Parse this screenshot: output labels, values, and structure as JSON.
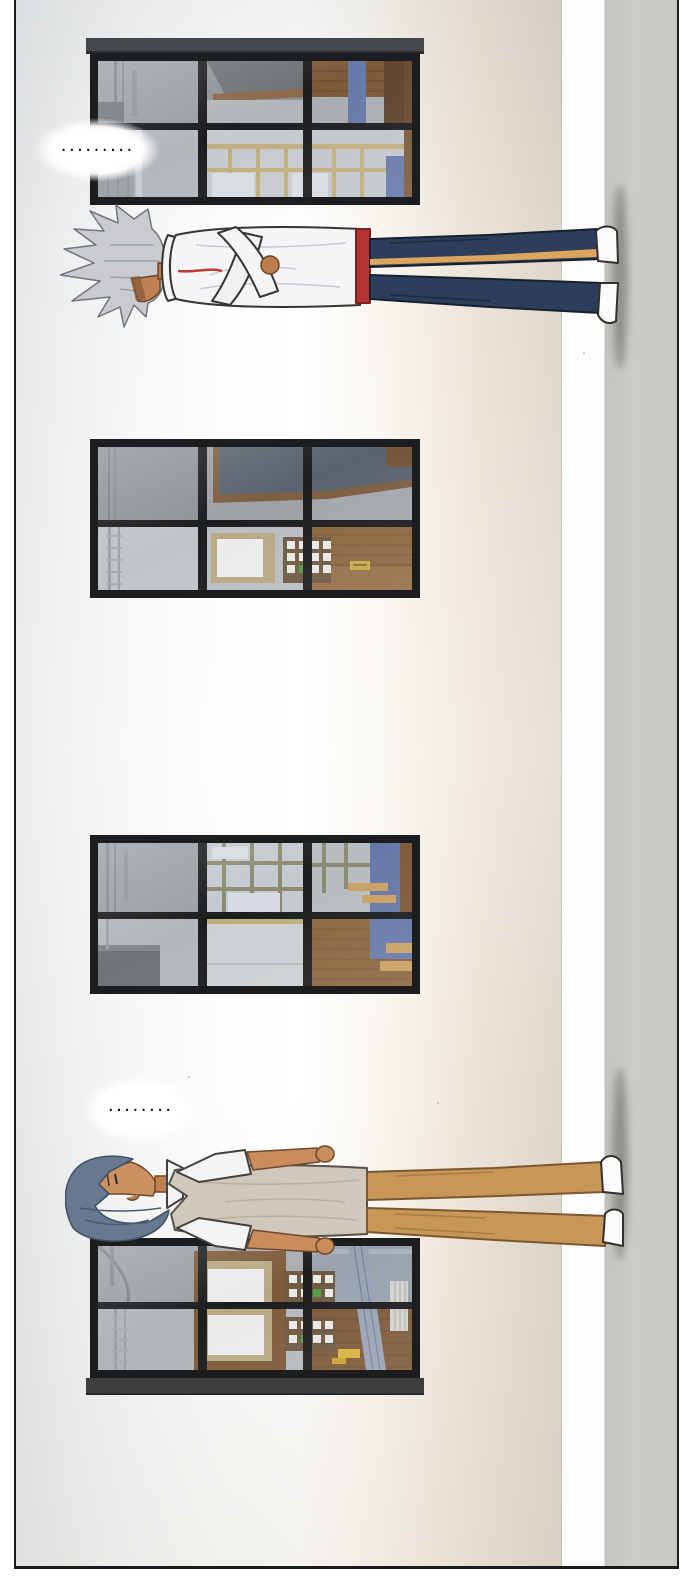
{
  "panel": {
    "kind": "webtoon comic panel, rotated scene of two students standing against a school wall",
    "speech_bubbles": [
      {
        "text": "........."
      },
      {
        "text": "........"
      }
    ],
    "characters": [
      {
        "id": "silver-haired-student",
        "hair": "silver spiky",
        "outfit": "white track jacket with red collar trim, red waistband, navy track pants with tan side stripe, white sneakers",
        "pose": "standing against wall, arms crossed, eyes hidden under bangs"
      },
      {
        "id": "blue-haired-student",
        "hair": "blue-grey bowl cut",
        "outfit": "beige sweater vest, white short-sleeved shirt, dark red tie, tan trousers, white shoes",
        "pose": "standing against wall, chin up, arms at sides"
      }
    ],
    "windows_count": 4,
    "palette": {
      "wall_light": "#eef0f1",
      "wall_beige": "#ded6cb",
      "ground_grey": "#c9c9c3",
      "window_frame": "#1b1d1f",
      "glass_top": "#9aa0a5",
      "glass_bottom": "#c2c6ca",
      "interior_wood": "#7d5a3a",
      "interior_blue": "#6679a8",
      "interior_mullion_beige": "#bfae7e",
      "chalkboard": "#5a646e",
      "jacket_white": "#f4f5f7",
      "pants_navy": "#2c3e59",
      "stripe_tan": "#dba55e",
      "waistband_red": "#b43434",
      "vest_beige": "#d0c9bb",
      "tie_red": "#9e2e2b",
      "pants_tan": "#c79757",
      "hair_silver": "#c9cbce",
      "hair_blue": "#66798e",
      "skin": "#c98c5c",
      "dot_color": "#151515"
    }
  }
}
